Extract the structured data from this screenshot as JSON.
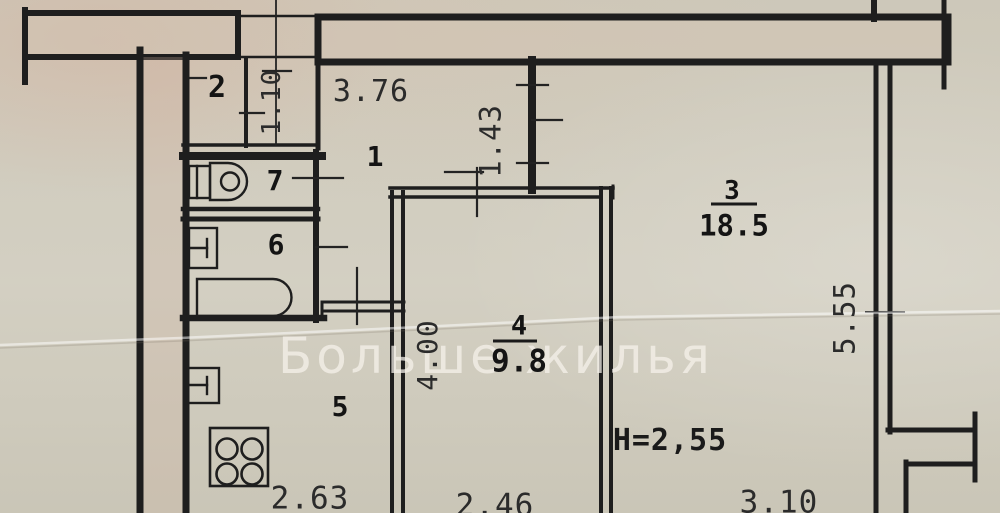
{
  "plan": {
    "watermark": "Больше жилья",
    "rooms": {
      "r1": {
        "number": "1"
      },
      "r2": {
        "number": "2"
      },
      "r3": {
        "number": "3",
        "area": "18.5"
      },
      "r4": {
        "number": "4",
        "area": "9.8"
      },
      "r5": {
        "number": "5"
      },
      "r6": {
        "number": "6"
      },
      "r7": {
        "number": "7"
      }
    },
    "dimensions": {
      "hall_width": "3.76",
      "closet_depth": "1.10",
      "living_opening": "1.43",
      "living_depth": "5.55",
      "room4_depth": "4.00",
      "kitchen_width": "2.63",
      "room4_width": "2.46",
      "living_width": "3.10",
      "ceiling_height": "Н=2,55"
    },
    "colors": {
      "paper": "#d1cdbf",
      "wall_line": "#1e1e1e",
      "wall_fill": "#d2c2b2",
      "watermark_text": "#f3f0e8"
    }
  }
}
